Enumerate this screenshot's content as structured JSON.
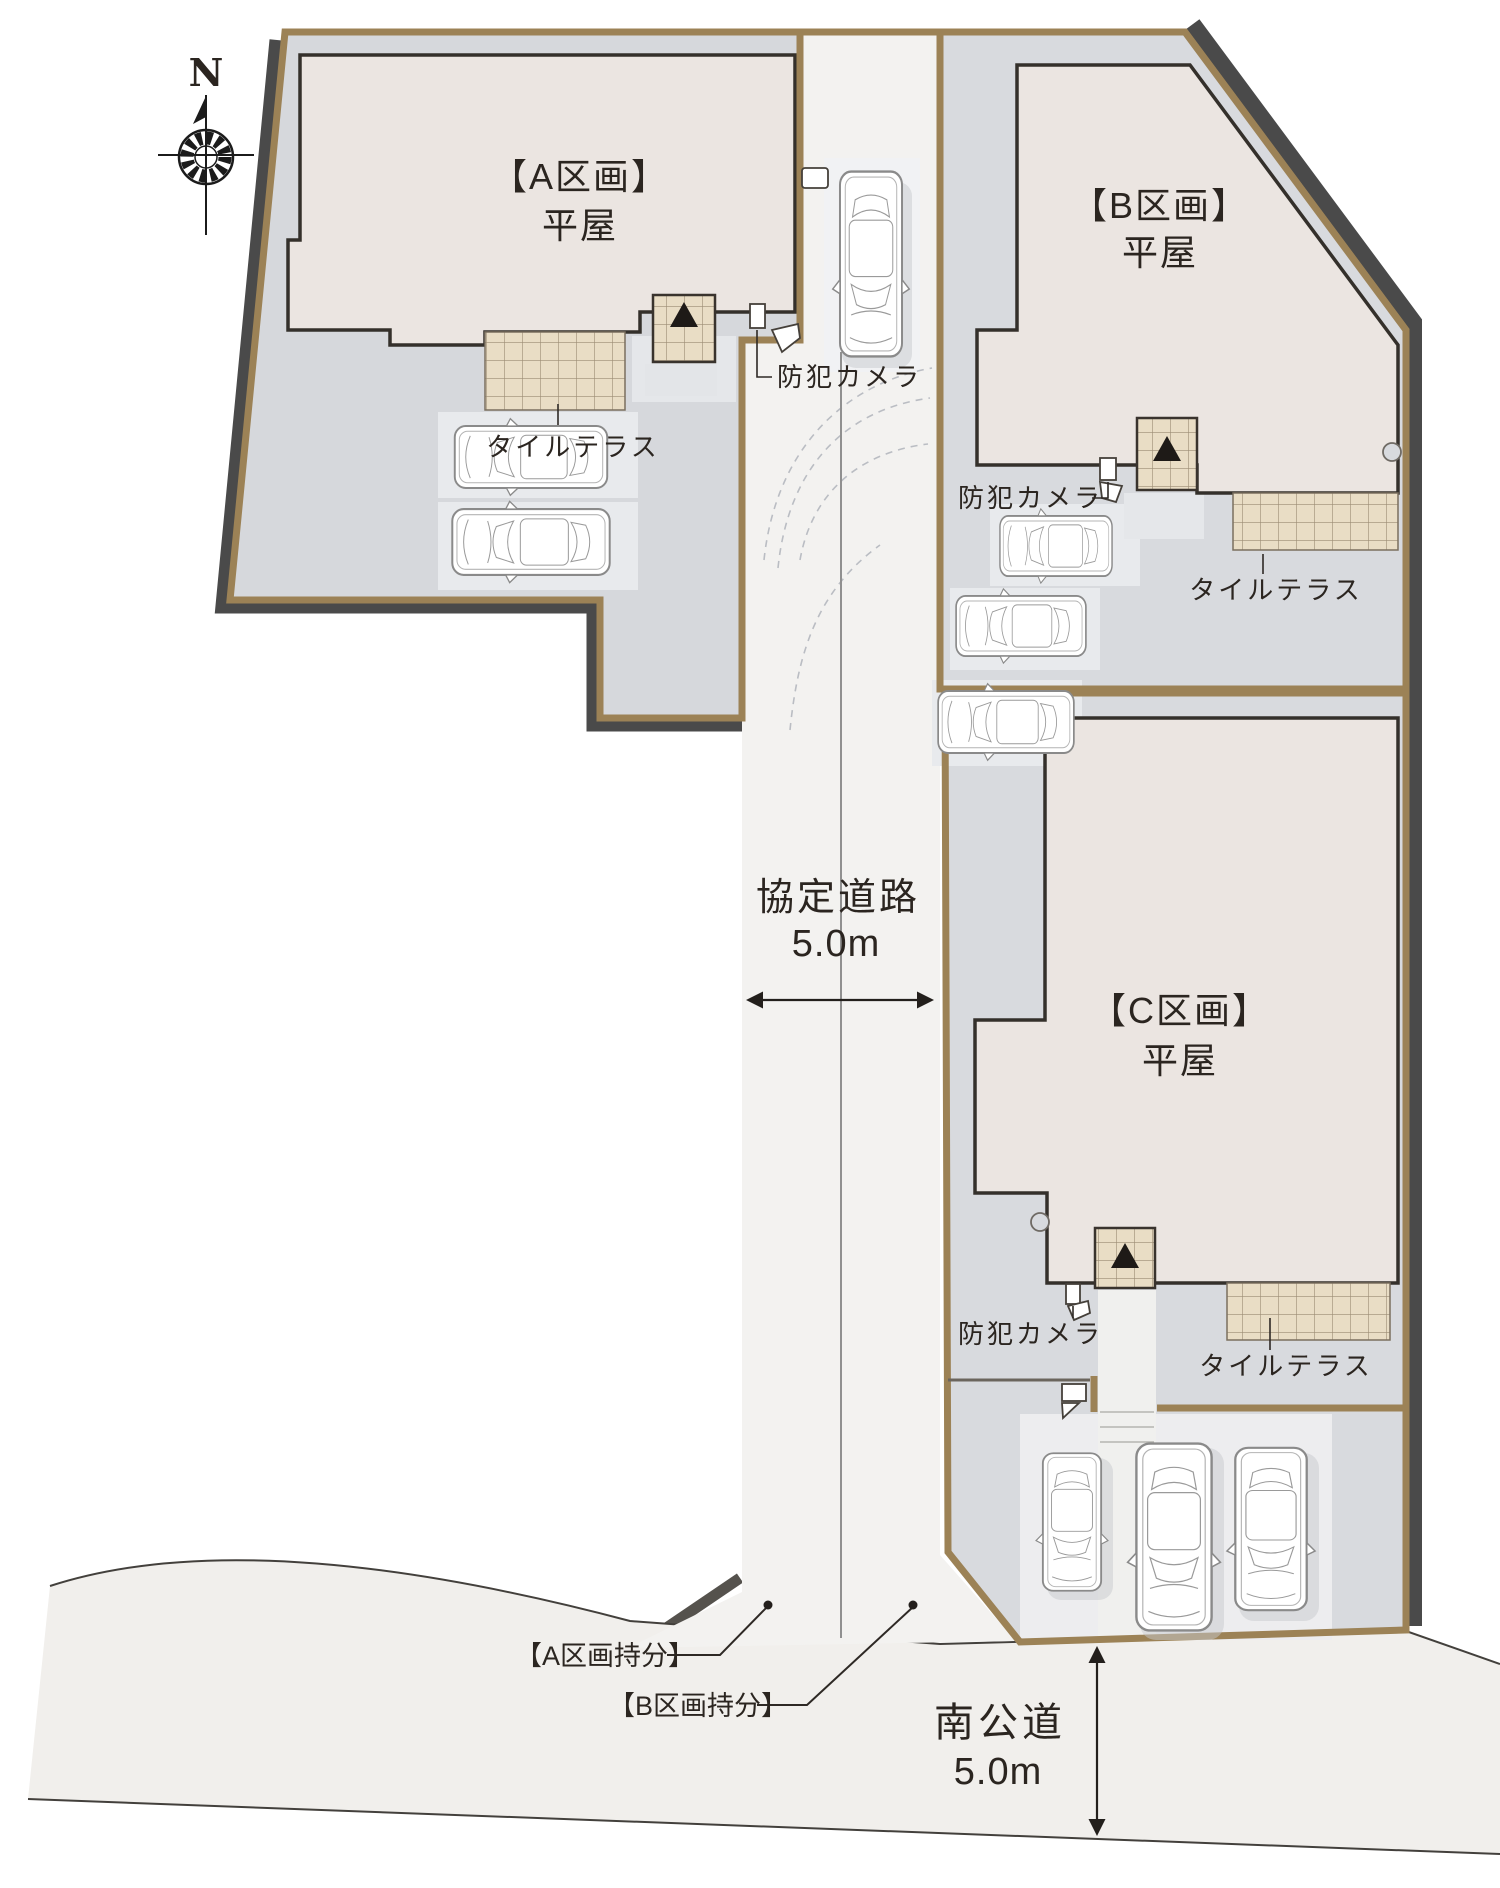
{
  "compass": {
    "north_label": "N"
  },
  "lots": [
    {
      "id": "A",
      "name": "【A区画】",
      "building_type": "平屋",
      "terrace_label": "タイルテラス",
      "camera_label": "防犯カメラ"
    },
    {
      "id": "B",
      "name": "【B区画】",
      "building_type": "平屋",
      "terrace_label": "タイルテラス",
      "camera_label": "防犯カメラ"
    },
    {
      "id": "C",
      "name": "【C区画】",
      "building_type": "平屋",
      "terrace_label": "タイルテラス",
      "camera_label": "防犯カメラ"
    }
  ],
  "shared_road": {
    "name": "協定道路",
    "width": "5.0m",
    "share_label_a": "【A区画持分】",
    "share_label_b": "【B区画持分】"
  },
  "south_road": {
    "name": "南公道",
    "width": "5.0m"
  },
  "colors": {
    "boundary_brown": "#9c8256",
    "building_fill": "#ebe5e1",
    "tile_fill": "#e9ddc5",
    "concrete": "#d7d9dc",
    "road_fill": "#f2f1ef",
    "shadow": "#4a4a4a",
    "text": "#2b2520"
  }
}
